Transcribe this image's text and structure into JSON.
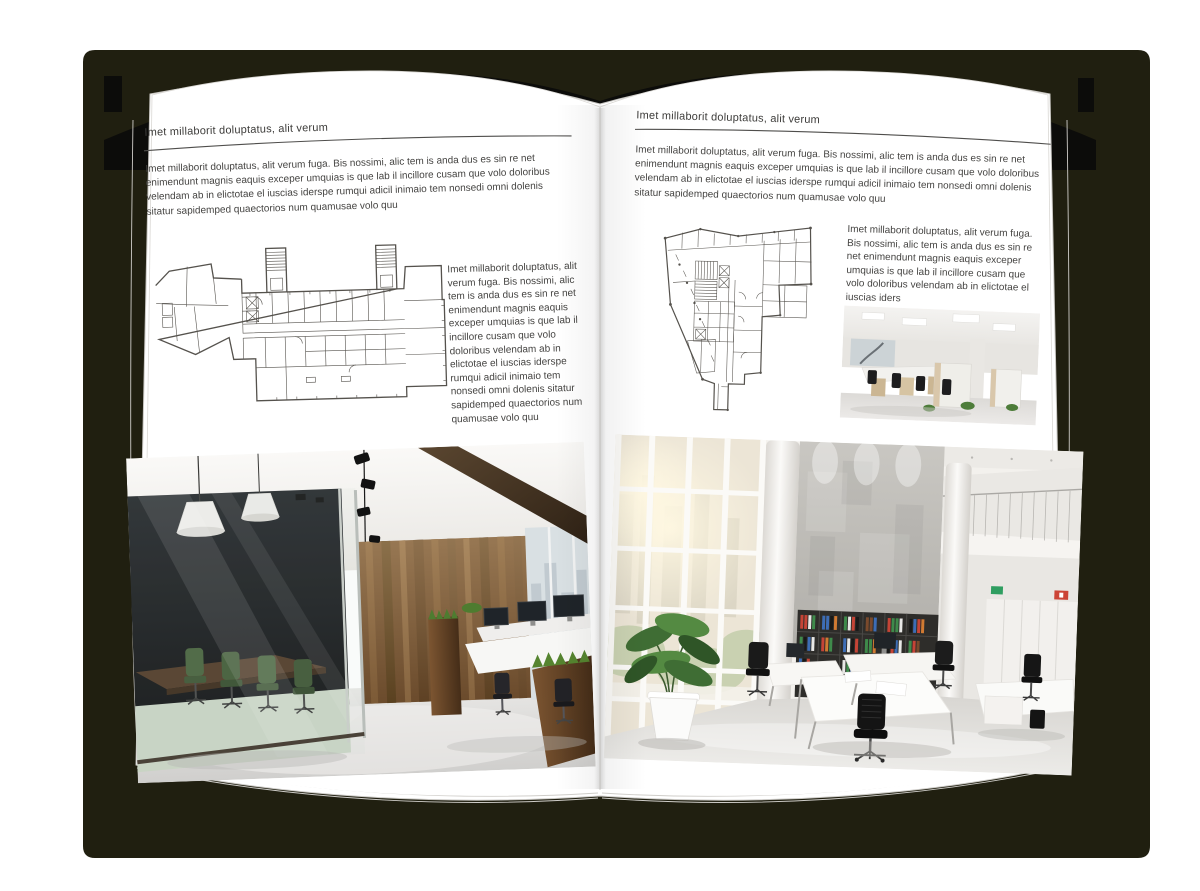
{
  "book": {
    "colors": {
      "backdrop_shadow": "#201f10",
      "cover": "#0c0c0a",
      "page": "#ffffff",
      "body_text": "#454442",
      "plan_line": "#55524d"
    }
  },
  "left_page": {
    "header": "Imet millaborit doluptatus, alit verum",
    "intro": "Imet millaborit doluptatus, alit verum fuga. Bis nossimi, alic tem is anda dus es sin re net enimendunt magnis eaquis exceper umquias is que lab il incillore cusam que volo doloribus velendam ab in elictotae el iuscias iderspe rumqui adicil inimaio tem nonsedi omni dolenis sitatur sapidemped quaectorios num quamusae volo quu",
    "side_text": "Imet millaborit doluptatus, alit verum fuga. Bis nossimi, alic tem is anda dus es sin re net enimendunt magnis eaquis exceper umquias is que lab il incillore cusam que volo doloribus velendam ab in elictotae el iuscias iderspe rumqui adicil inimaio tem nonsedi omni dolenis sitatur sapidemped quaectorios num quamusae volo quu"
  },
  "right_page": {
    "header": "Imet millaborit doluptatus, alit verum",
    "intro": "Imet millaborit doluptatus, alit verum fuga. Bis nossimi, alic tem is anda dus es sin re net enimendunt magnis eaquis exceper umquias is que lab il incillore cusam que volo doloribus velendam ab in elictotae el iuscias iderspe rumqui adicil inimaio tem nonsedi omni dolenis sitatur sapidemped quaectorios num quamusae volo quu",
    "side_text": "Imet millaborit doluptatus, alit verum fuga. Bis nossimi, alic tem is anda dus es sin re net enimendunt magnis eaquis exceper umquias is que lab il incillore cusam que volo doloribus velendam ab in elictotae el iuscias iders"
  },
  "figures": {
    "left_floorplan": "building-floor-plan-drawing",
    "right_floorplan": "irregular-building-floor-plan-drawing",
    "left_photo": "loft-office-interior-photo",
    "small_photo": "open-plan-office-photo",
    "right_photo": "bright-atrium-office-photo"
  }
}
